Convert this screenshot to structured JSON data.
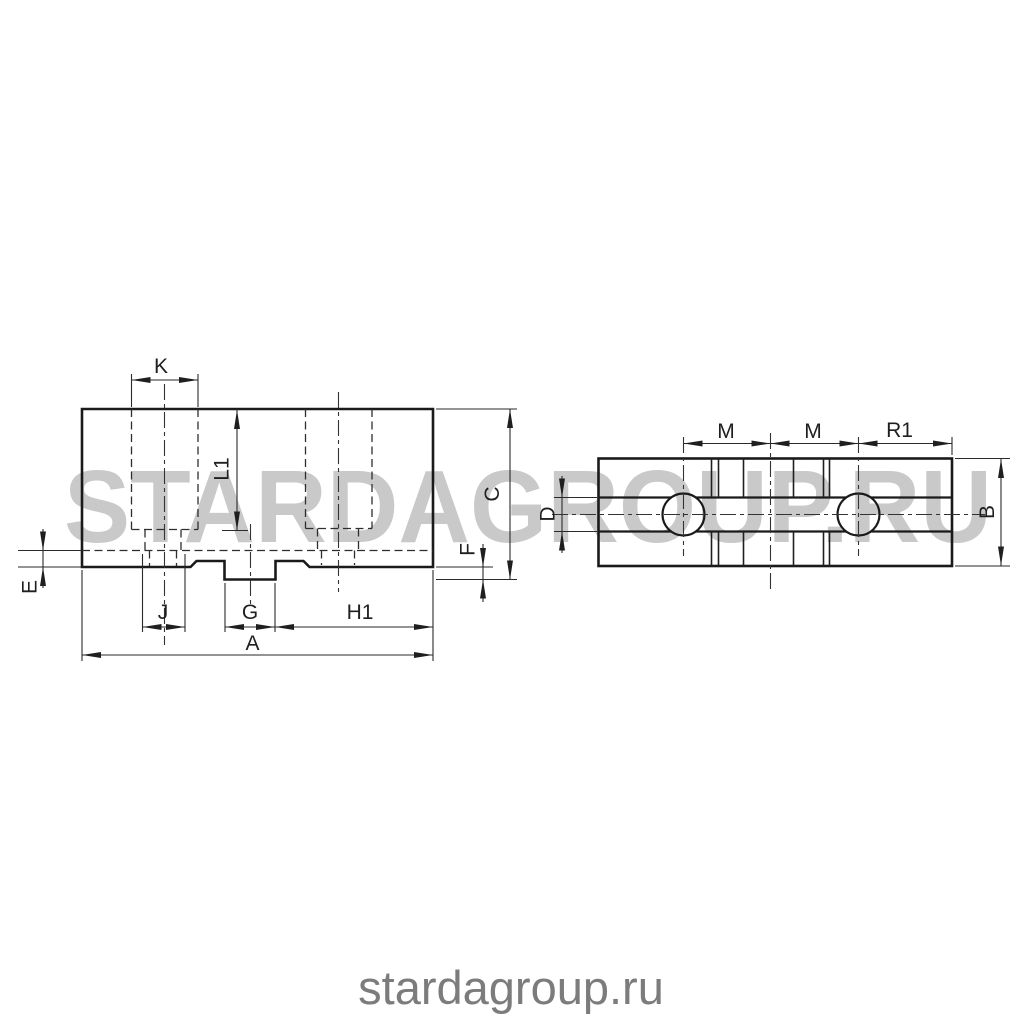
{
  "watermark": {
    "text": "STARDAGROUP.RU",
    "color": "#c9c9c9"
  },
  "footer": {
    "text": "stardagroup.ru",
    "color": "#7c7c7c"
  },
  "drawing": {
    "line_color": "#1f1f1f",
    "side_view_labels": {
      "k": "K",
      "l1": "L1",
      "c": "C",
      "f": "F",
      "e": "E",
      "j": "J",
      "g": "G",
      "h1": "H1",
      "a": "A"
    },
    "top_view_labels": {
      "d": "D",
      "m_left": "M",
      "m_right": "M",
      "r1": "R1",
      "b": "B"
    }
  }
}
